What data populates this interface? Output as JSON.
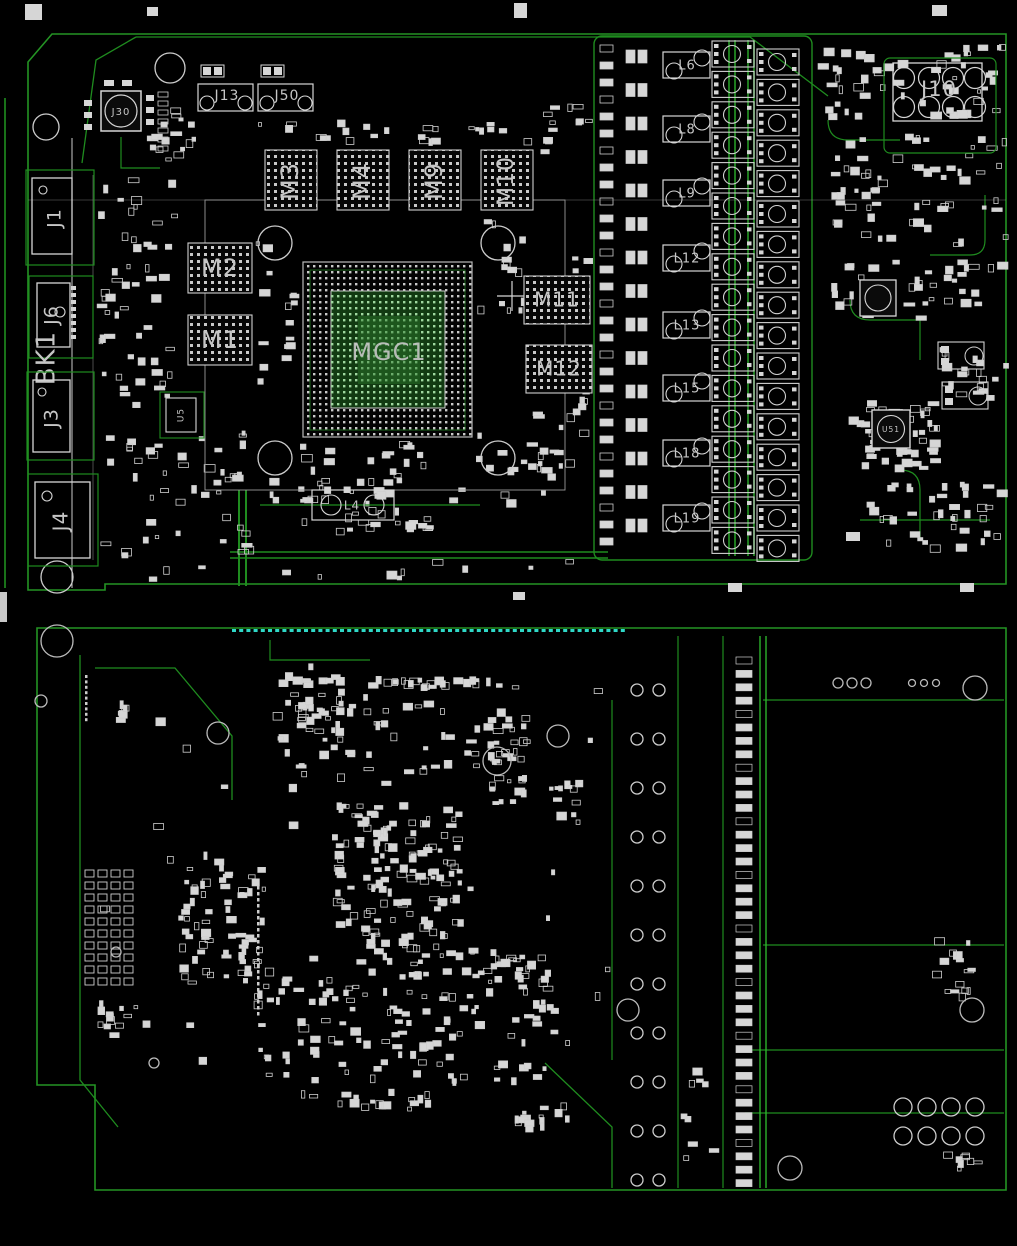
{
  "colors": {
    "background": "#000000",
    "trace_green": "#1f8c1f",
    "bright_green": "#2fc42f",
    "pad_white": "#d6d6d6",
    "silk_gray": "#c6c6c6",
    "cyan_silk": "#2fd8c8"
  },
  "top_view": {
    "bracket_connectors": [
      {
        "label": "J1"
      },
      {
        "label": "J6"
      },
      {
        "label": "BK1"
      },
      {
        "label": "J3"
      },
      {
        "label": "J4"
      }
    ],
    "top_edge_components": [
      {
        "label": "J30"
      },
      {
        "label": "J13"
      },
      {
        "label": "J50"
      }
    ],
    "memory_chips": [
      {
        "label": "M3"
      },
      {
        "label": "M4"
      },
      {
        "label": "M9"
      },
      {
        "label": "M10"
      },
      {
        "label": "M2"
      },
      {
        "label": "M1"
      },
      {
        "label": "M11"
      },
      {
        "label": "M12"
      }
    ],
    "gpu": {
      "label": "MGC1"
    },
    "power_inductors": [
      {
        "label": "L6"
      },
      {
        "label": "L8"
      },
      {
        "label": "L9"
      },
      {
        "label": "L12"
      },
      {
        "label": "L13"
      },
      {
        "label": "L15"
      },
      {
        "label": "L18"
      },
      {
        "label": "L19"
      }
    ],
    "small_inductor": {
      "label": "L4"
    },
    "small_ic": {
      "label": "U5"
    },
    "power_connector": {
      "label": "J10"
    },
    "right_circular_ic": {
      "label": "U51"
    }
  }
}
